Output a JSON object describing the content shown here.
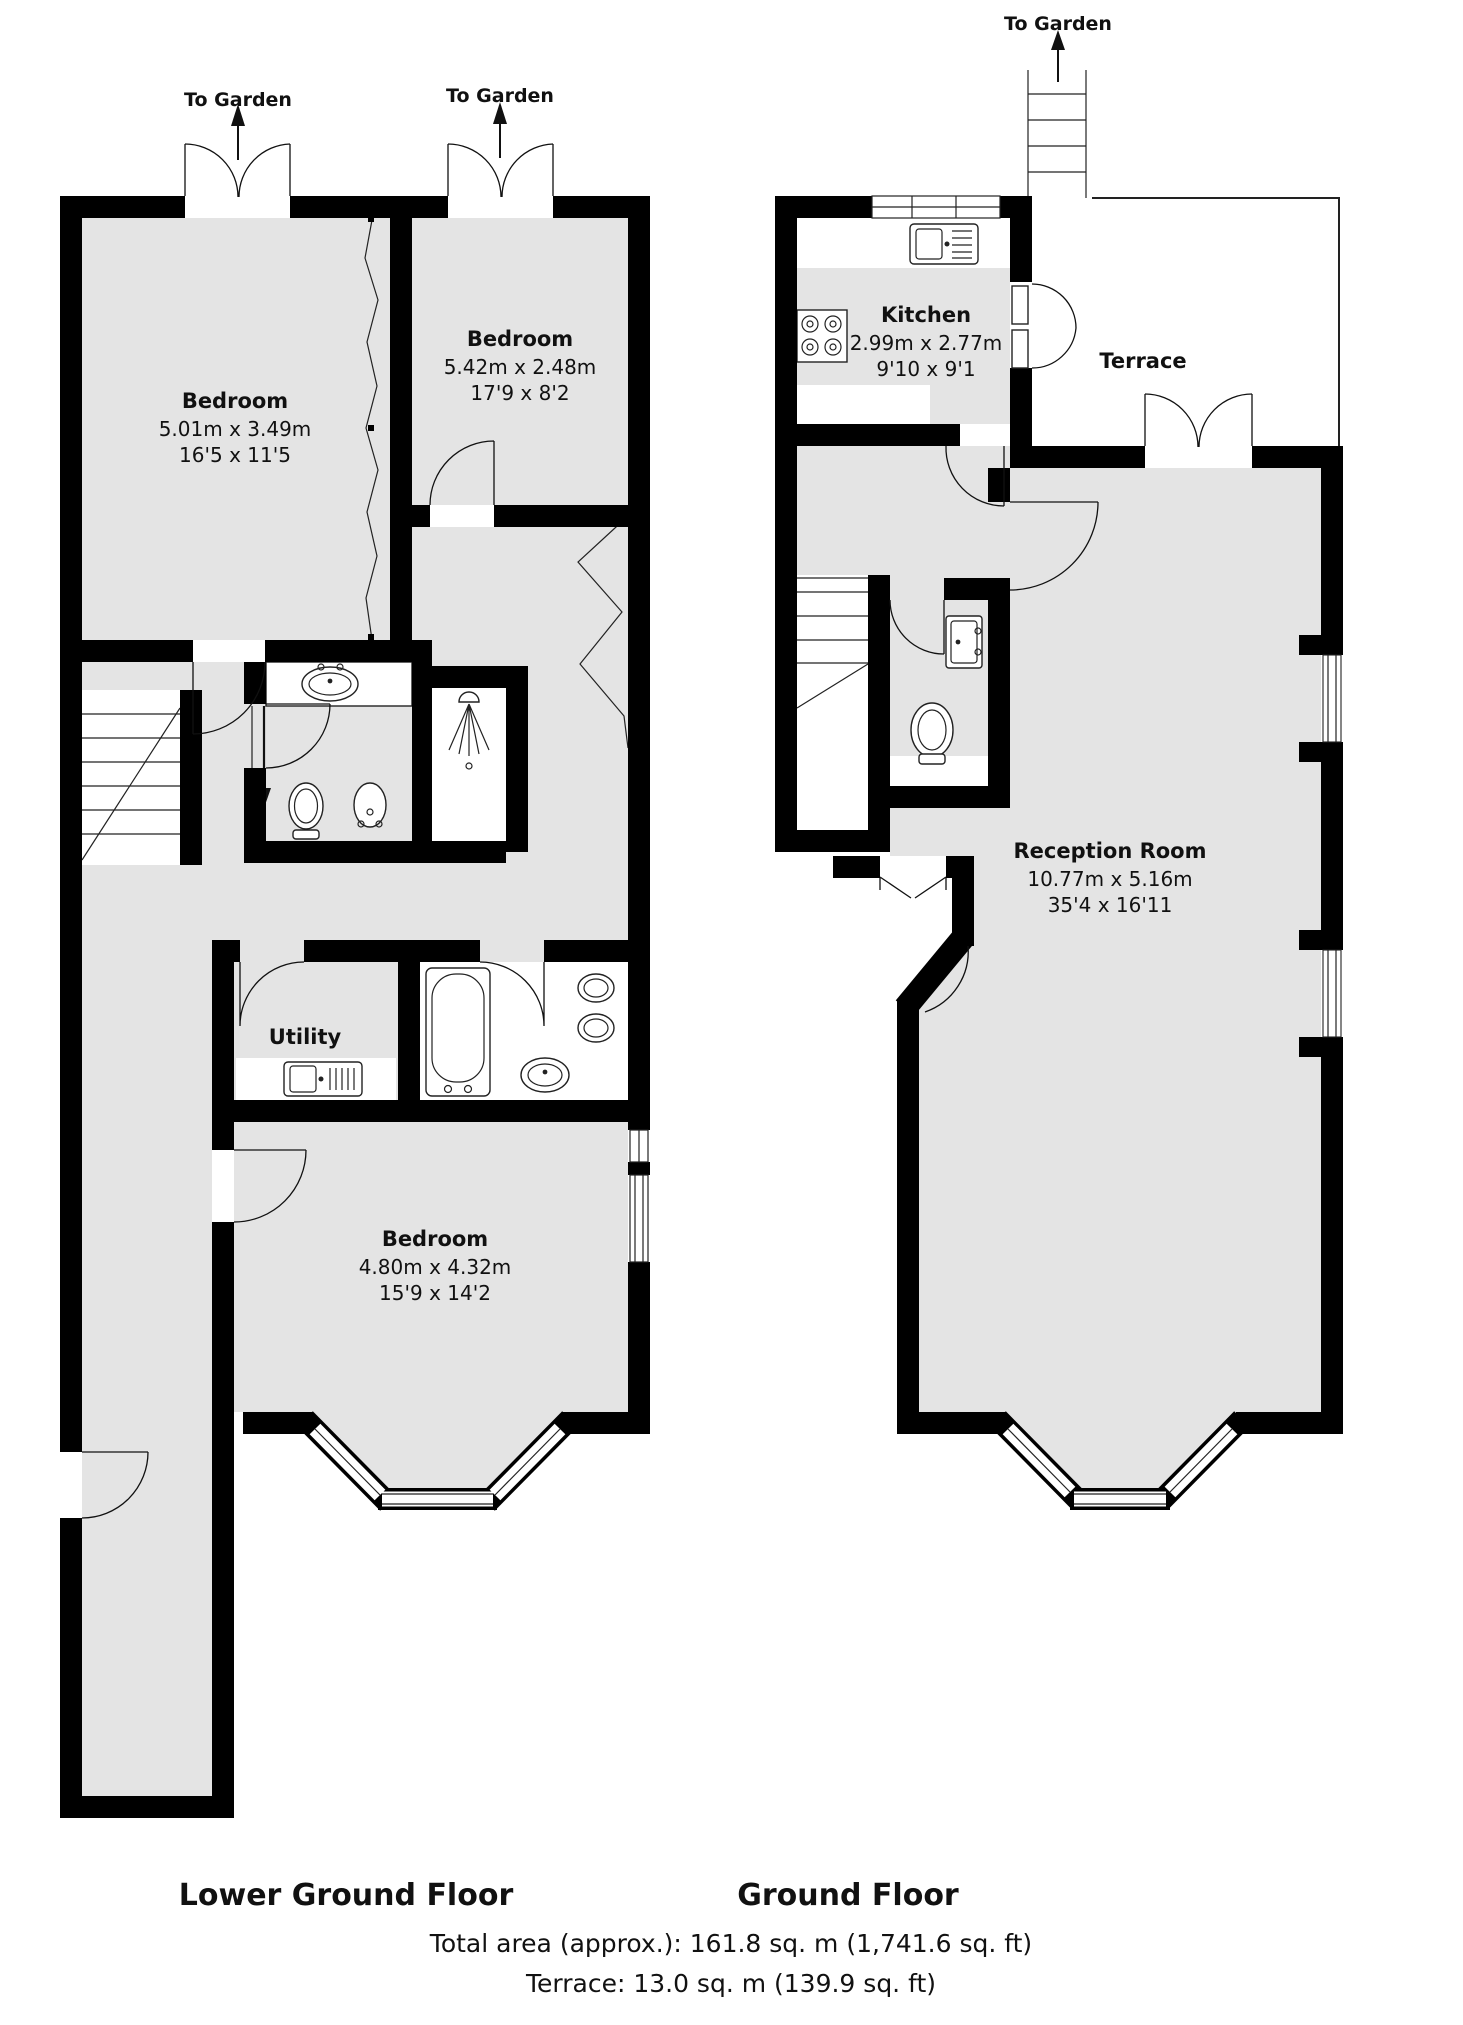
{
  "colors": {
    "wall": "#000000",
    "floor": "#e4e4e4",
    "accent": "#111111"
  },
  "labels": {
    "to_garden": "To Garden"
  },
  "floors": [
    {
      "title": "Lower Ground Floor",
      "rooms": [
        {
          "name": "Bedroom",
          "metric": "5.01m x 3.49m",
          "imperial": "16'5 x 11'5"
        },
        {
          "name": "Bedroom",
          "metric": "5.42m x 2.48m",
          "imperial": "17'9 x 8'2"
        },
        {
          "name": "Utility"
        },
        {
          "name": "Bedroom",
          "metric": "4.80m x 4.32m",
          "imperial": "15'9 x 14'2"
        }
      ]
    },
    {
      "title": "Ground Floor",
      "rooms": [
        {
          "name": "Kitchen",
          "metric": "2.99m x 2.77m",
          "imperial": "9'10 x 9'1"
        },
        {
          "name": "Terrace"
        },
        {
          "name": "Reception Room",
          "metric": "10.77m x 5.16m",
          "imperial": "35'4 x 16'11"
        }
      ]
    }
  ],
  "footer": {
    "total": "Total area (approx.): 161.8 sq. m (1,741.6 sq. ft)",
    "terrace": "Terrace: 13.0 sq. m (139.9 sq. ft)"
  }
}
